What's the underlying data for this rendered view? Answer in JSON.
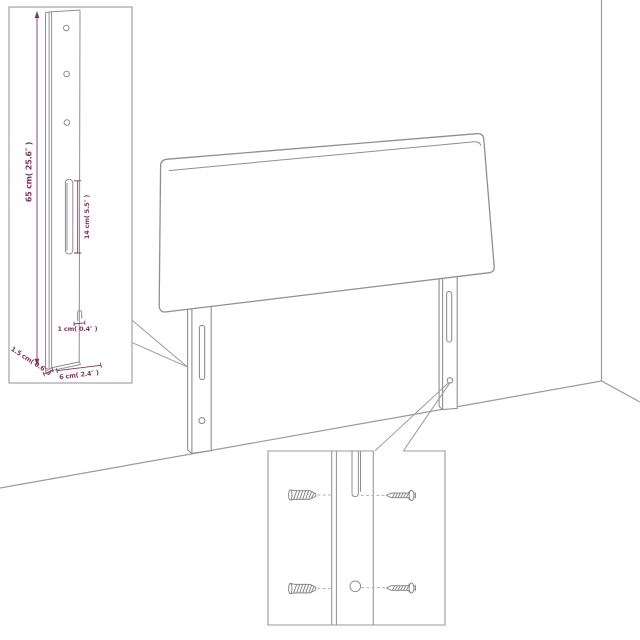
{
  "figure": {
    "description": "headboard assembly diagram",
    "colors": {
      "dimension_text": "#82355c",
      "line_art": "#8f8f8f",
      "wall_line": "#9a9a9a",
      "callout_border": "#9b9b9b",
      "background": "#ffffff"
    }
  },
  "detail_top_left": {
    "labels": {
      "leg_height": "65 cm( 25.6″ )",
      "slot_length": "14 cm( 5.5″ )",
      "hook_offset": "1 cm( 0.4″ )",
      "leg_thickness": "1.5 cm( 0.6″ )",
      "leg_width": "6 cm( 2.4″ )"
    }
  },
  "detail_bottom": {
    "hardware": [
      "wall-plug",
      "screw",
      "wall-plug",
      "screw"
    ]
  }
}
